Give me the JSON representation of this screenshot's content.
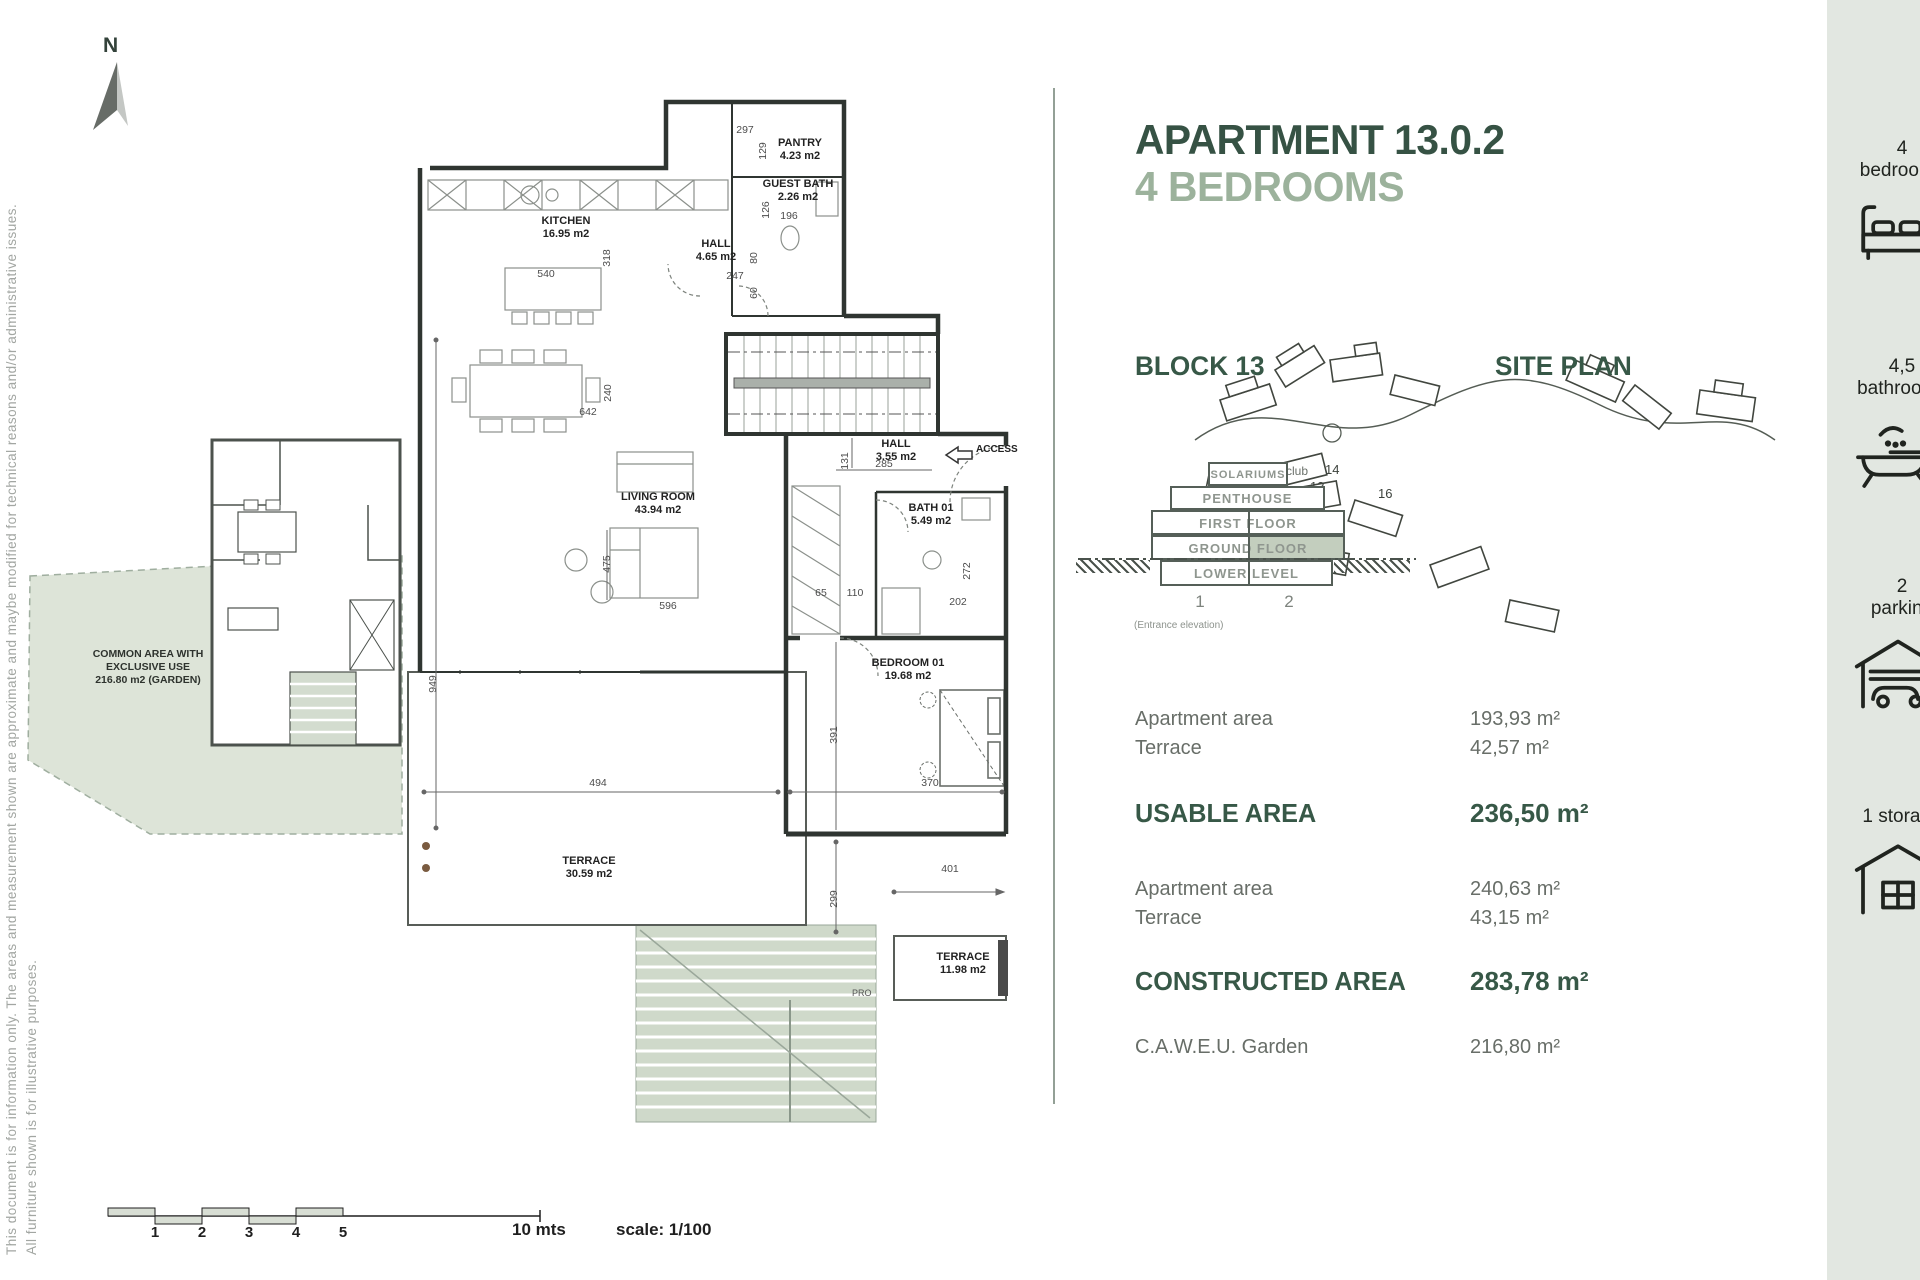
{
  "page": {
    "note_line1": "This document is for information only. The areas and measurement shown are approximate and maybe modified for technical reasons and/or administrative issues.",
    "note_line2": "All furniture shown is for illustrative purposes.",
    "north_label": "N"
  },
  "header": {
    "title": "APARTMENT 13.0.2",
    "subtitle": "4 BEDROOMS"
  },
  "sections": {
    "block_title": "BLOCK 13",
    "site_plan_title": "SITE PLAN"
  },
  "elevation": {
    "floors": [
      "SOLARIUMS",
      "PENTHOUSE",
      "FIRST FLOOR",
      "GROUND FLOOR",
      "LOWER LEVEL"
    ],
    "unit_labels": [
      "1",
      "2"
    ],
    "caption": "(Entrance elevation)",
    "highlight_color": "#c3cebe"
  },
  "site_plan": {
    "labels": {
      "club": "club",
      "b12": "12",
      "b13": "13",
      "b14": "14",
      "b15": "15",
      "b16": "16"
    }
  },
  "areas": {
    "usable_rows": [
      {
        "label": "Apartment area",
        "value": "193,93 m²"
      },
      {
        "label": "Terrace",
        "value": "42,57 m²"
      }
    ],
    "usable_total_label": "USABLE AREA",
    "usable_total_value": "236,50 m²",
    "constructed_rows": [
      {
        "label": "Apartment area",
        "value": "240,63 m²"
      },
      {
        "label": "Terrace",
        "value": "43,15 m²"
      }
    ],
    "constructed_total_label": "CONSTRUCTED AREA",
    "constructed_total_value": "283,78 m²",
    "garden_label": "C.A.W.E.U. Garden",
    "garden_value": "216,80 m²"
  },
  "sidebar": {
    "items": [
      {
        "count": "4",
        "label": "bedrooms"
      },
      {
        "count": "4,5",
        "label": "bathrooms"
      },
      {
        "count": "2",
        "label": "parking"
      },
      {
        "count": "",
        "label": "1 storage"
      }
    ]
  },
  "scalebar": {
    "ticks": [
      "1",
      "2",
      "3",
      "4",
      "5"
    ],
    "length_label": "10 mts",
    "scale_label": "scale: 1/100"
  },
  "floorplan": {
    "rooms": {
      "pantry": {
        "name": "PANTRY",
        "area": "4.23 m2"
      },
      "guest_bath": {
        "name": "GUEST BATH",
        "area": "2.26 m2"
      },
      "kitchen": {
        "name": "KITCHEN",
        "area": "16.95 m2"
      },
      "hall_upper": {
        "name": "HALL",
        "area": "4.65 m2"
      },
      "living": {
        "name": "LIVING ROOM",
        "area": "43.94 m2"
      },
      "hall_lower": {
        "name": "HALL",
        "area": "3.55 m2"
      },
      "bath01": {
        "name": "BATH 01",
        "area": "5.49 m2"
      },
      "bedroom01": {
        "name": "BEDROOM 01",
        "area": "19.68 m2"
      },
      "terrace_main": {
        "name": "TERRACE",
        "area": "30.59 m2"
      },
      "terrace_small": {
        "name": "TERRACE",
        "area": "11.98 m2"
      }
    },
    "common_area": {
      "line1": "COMMON AREA WITH",
      "line2": "EXCLUSIVE USE",
      "line3": "216.80 m2 (GARDEN)"
    },
    "access_label": "ACCESS",
    "pro_label": "PRO",
    "dims": [
      "297",
      "129",
      "126",
      "196",
      "318",
      "540",
      "247",
      "80",
      "60",
      "240",
      "642",
      "131",
      "285",
      "475",
      "596",
      "65",
      "110",
      "202",
      "272",
      "949",
      "391",
      "494",
      "370",
      "401",
      "299"
    ]
  }
}
